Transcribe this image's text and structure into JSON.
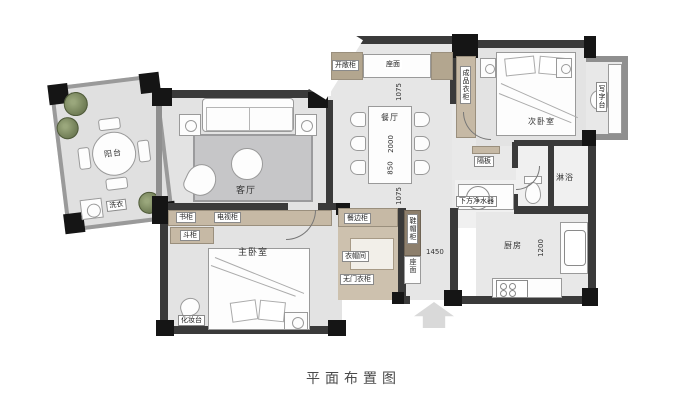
{
  "title": "平面布置图",
  "colors": {
    "wall": "#3a3a3a",
    "pillar": "#151515",
    "wood": "#c6b9a5",
    "wood_dark": "#8d7f6c",
    "floor": "#e3e3e3",
    "rug": "#c6c6c8",
    "plant_green": "#77845c"
  },
  "rooms": {
    "balcony": {
      "label": "阳台"
    },
    "living": {
      "label": "客厅"
    },
    "dining": {
      "label": "餐厅"
    },
    "master_bedroom": {
      "label": "主卧室"
    },
    "second_bedroom": {
      "label": "次卧室"
    },
    "kitchen": {
      "label": "厨房"
    },
    "shower_room": {
      "label": "淋浴"
    },
    "cloakroom": {
      "label": "衣帽间"
    },
    "study_nook": {
      "label": "写字台"
    }
  },
  "furniture": {
    "laundry": "洗衣",
    "bookcase": "书柜",
    "tv_cabinet": "电视柜",
    "chest": "斗柜",
    "dressing_table": "化妆台",
    "sideboard": "餐边柜",
    "open_cabinet": "开敞柜",
    "bench_top": "座面",
    "ready_wardrobe": "成品衣柜",
    "doorless_wardrobe": "无门衣柜",
    "shoe_hat_cabinet": "鞋帽柜",
    "entry_bench_top": "座面",
    "shelf_board": "隔板",
    "water_purifier": "下方净水器"
  },
  "dimensions": {
    "dining_top": "1075",
    "table_length": "2000",
    "table_width": "850",
    "dining_bottom": "1075",
    "entry_hall": "1450",
    "kitchen": "1200"
  }
}
